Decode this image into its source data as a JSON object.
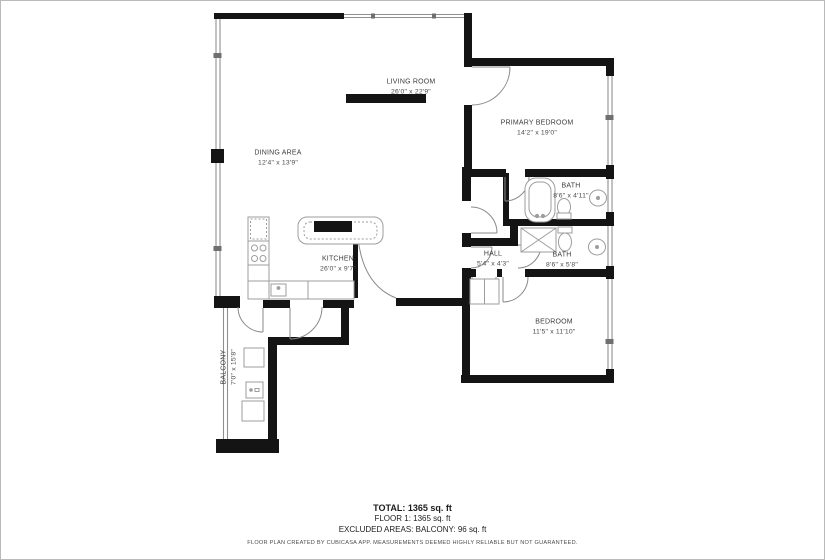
{
  "plan": {
    "rooms": [
      {
        "id": "living-room",
        "name": "LIVING ROOM",
        "dims": "26'0\" x 22'9\""
      },
      {
        "id": "dining-area",
        "name": "DINING AREA",
        "dims": "12'4\" x 13'9\""
      },
      {
        "id": "kitchen",
        "name": "KITCHEN",
        "dims": "26'0\" x 9'7\""
      },
      {
        "id": "primary-bedroom",
        "name": "PRIMARY BEDROOM",
        "dims": "14'2\" x 19'0\""
      },
      {
        "id": "bath-1",
        "name": "BATH",
        "dims": "8'6\" x 4'11\""
      },
      {
        "id": "bath-2",
        "name": "BATH",
        "dims": "8'6\" x 5'8\""
      },
      {
        "id": "hall",
        "name": "HALL",
        "dims": "5'4\" x 4'3\""
      },
      {
        "id": "bedroom",
        "name": "BEDROOM",
        "dims": "11'5\" x 11'10\""
      },
      {
        "id": "balcony",
        "name": "BALCONY",
        "dims": "7'0\" x 15'8\""
      }
    ],
    "summary": {
      "total": "TOTAL: 1365 sq. ft",
      "floor": "FLOOR 1: 1365 sq. ft",
      "excluded": "EXCLUDED AREAS: BALCONY: 96 sq. ft"
    },
    "disclaimer": "FLOOR PLAN CREATED BY CUBICASA APP. MEASUREMENTS DEEMED HIGHLY RELIABLE BUT NOT GUARANTEED.",
    "colors": {
      "wall": "#141414",
      "window_line": "#8f8f8f",
      "fixture_line": "#9d9d9d"
    }
  }
}
